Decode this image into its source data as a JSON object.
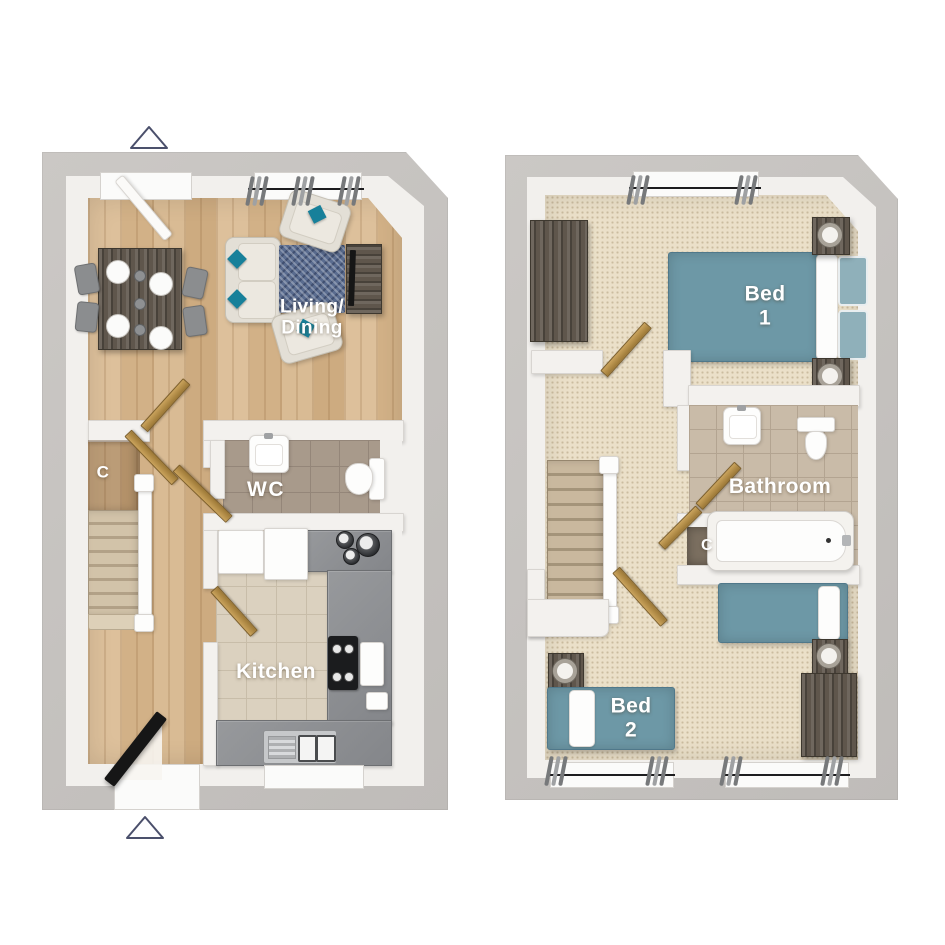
{
  "canvas": {
    "width": 945,
    "height": 945,
    "background": "#ffffff"
  },
  "colors": {
    "page_bg": "#ffffff",
    "wall_outer": "#c7c4c1",
    "wall_face": "#f2f0ed",
    "wall_inner": "#f3f1ee",
    "wall_edge": "#d8d5d1",
    "wood_mid": "#d3b288",
    "carpet": "#ebe0c9",
    "tile_wc": "#a89a8b",
    "tile_wc_line": "#948679",
    "tile_kitchen": "#dbd1bf",
    "tile_kitchen_line": "#c8bda9",
    "tile_bath": "#c9bba8",
    "tile_bath_line": "#b3a491",
    "counter_gray": "#8f9194",
    "fixture_white": "#fdfdfc",
    "fixture_edge": "#d8d5d1",
    "teal_duvet": "#6d98a6",
    "teal_pillow": "#8fb0ba",
    "teal_cushion": "#17809a",
    "rug_navy": "#5a6c8f",
    "door_gold_light": "#caa35c",
    "door_gold_dark": "#9c7836",
    "furniture_wood": "#5f564c",
    "sofa_cream": "#e3dfd6",
    "chair_gray": "#8b8d8f",
    "curtain_gray": "#77797b",
    "rod_black": "#1d1d1f",
    "marker_outline": "#4a4f6b",
    "label_white": "#ffffff",
    "front_door_black": "#161616",
    "closet_floor_dark": "#7b6f60"
  },
  "ground_floor": {
    "labels": {
      "living_dining": {
        "line1": "Living/",
        "line2": "Dining"
      },
      "wc": {
        "line1": "WC"
      },
      "kitchen": {
        "line1": "Kitchen"
      },
      "cupboard": {
        "line1": "C"
      }
    }
  },
  "first_floor": {
    "labels": {
      "bed1": {
        "line1": "Bed",
        "line2": "1"
      },
      "bathroom": {
        "line1": "Bathroom"
      },
      "cupboard": {
        "line1": "C"
      },
      "bed2": {
        "line1": "Bed",
        "line2": "2"
      }
    }
  }
}
